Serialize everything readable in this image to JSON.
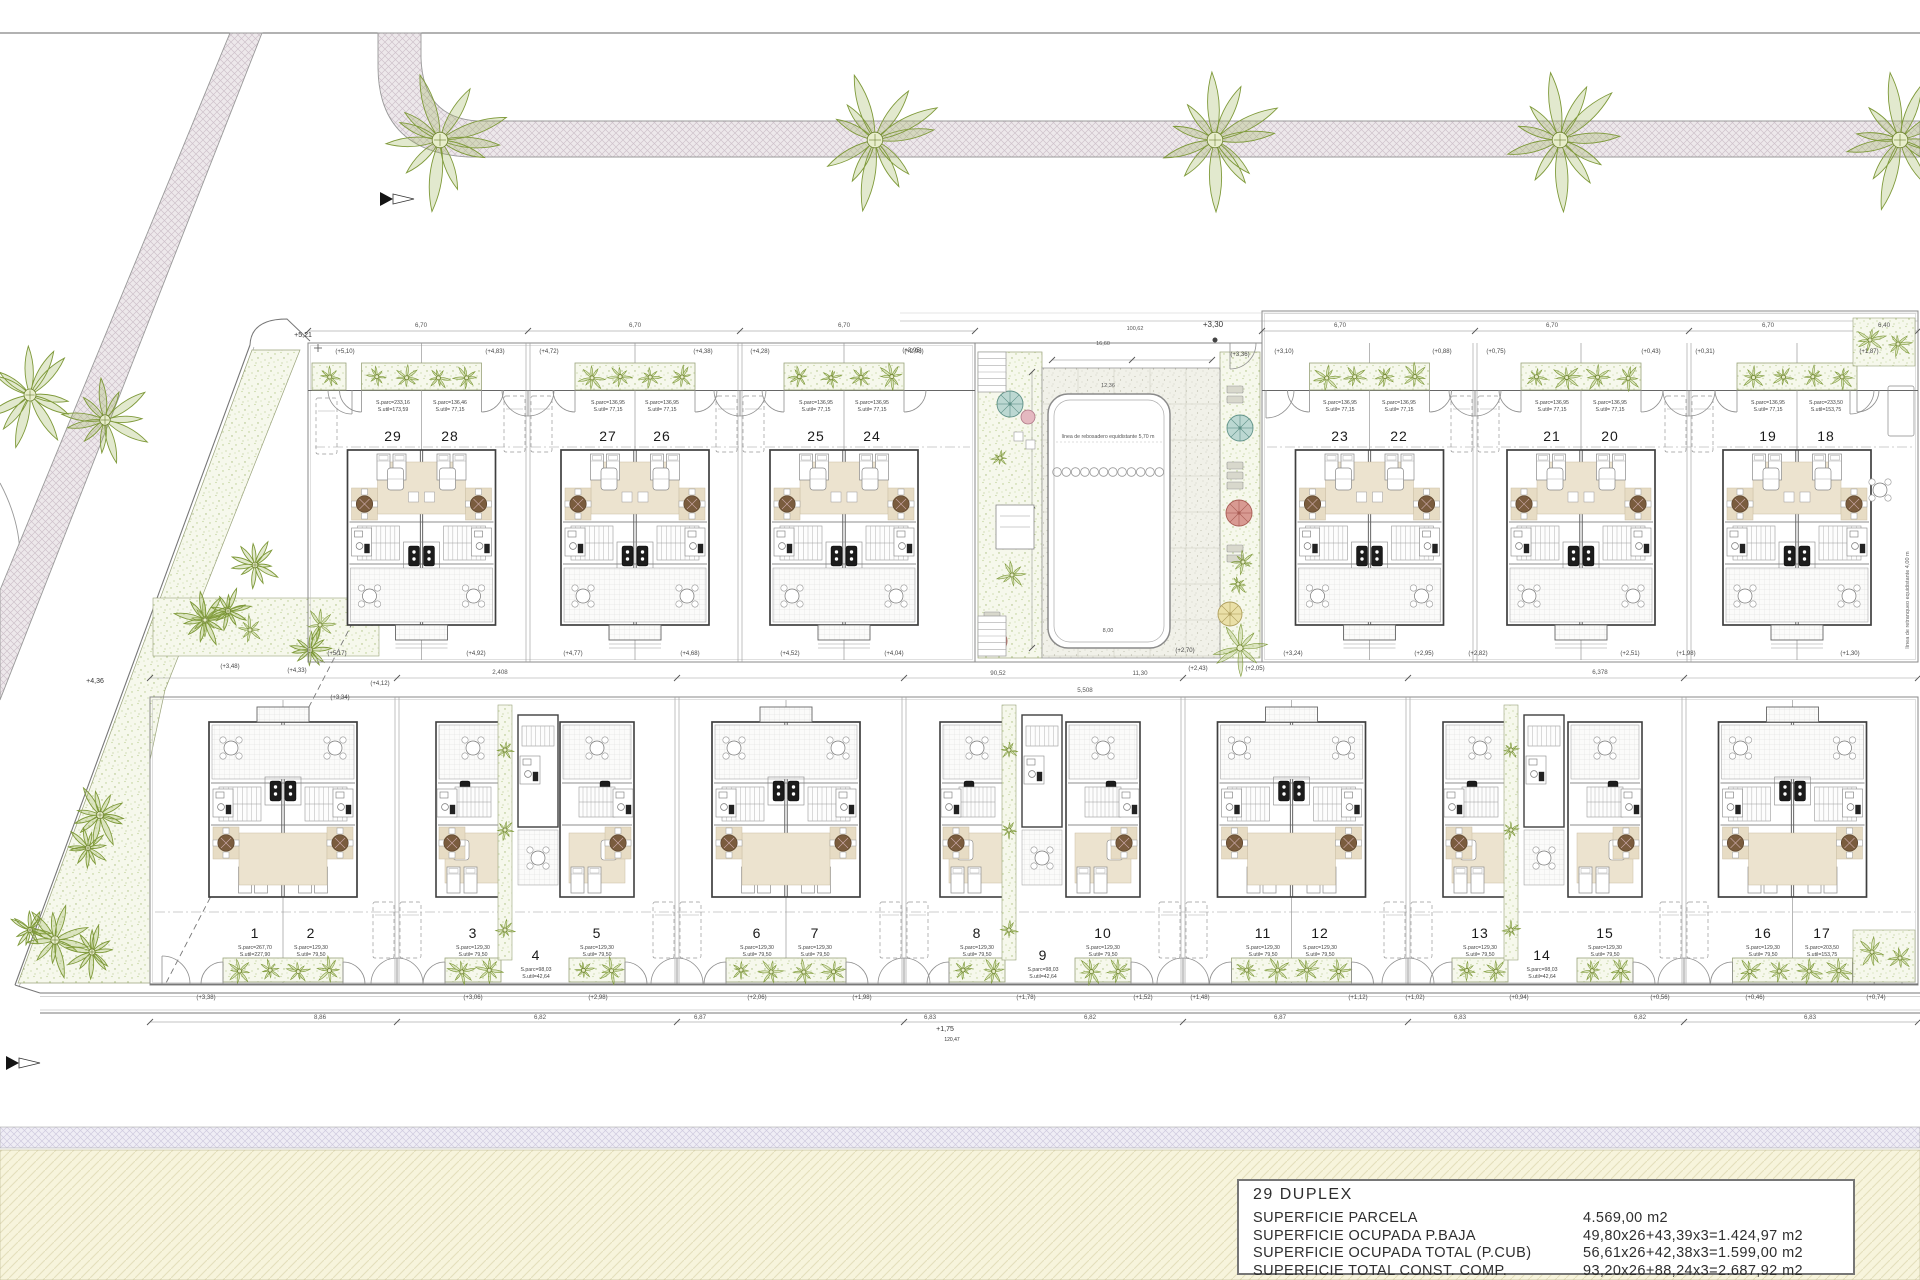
{
  "legend": {
    "title": "29 DUPLEX",
    "rows": [
      {
        "label": "SUPERFICIE PARCELA",
        "value": "4.569,00 m2"
      },
      {
        "label": "SUPERFICIE OCUPADA P.BAJA",
        "value": "49,80x26+43,39x3=1.424,97 m2"
      },
      {
        "label": "SUPERFICIE OCUPADA TOTAL (P.CUB)",
        "value": "56,61x26+42,38x3=1.599,00 m2"
      },
      {
        "label": "SUPERFICIE TOTAL CONST. COMP.",
        "value": "93,20x26+88,24x3=2.687,92 m2"
      }
    ]
  },
  "pool": {
    "note": "línea de rebosadero equidistante 5,70 m",
    "dims": [
      {
        "x": 1103,
        "y": 345,
        "t": "16,60"
      },
      {
        "x": 1108,
        "y": 387,
        "t": "12,36"
      },
      {
        "x": 1108,
        "y": 632,
        "t": "8,00"
      },
      {
        "x": 1135,
        "y": 330,
        "t": "100,62"
      }
    ],
    "level_top_right": "(+3,36)",
    "level_deck": "(+2,70)"
  },
  "markers": [
    {
      "x": 303,
      "y": 337,
      "t": "+5,21",
      "s": 7
    },
    {
      "x": 95,
      "y": 683,
      "t": "+4,36",
      "s": 7
    },
    {
      "x": 1213,
      "y": 327,
      "t": "+3,30",
      "s": 8
    },
    {
      "x": 945,
      "y": 1031,
      "t": "+1,75",
      "s": 7
    },
    {
      "x": 952,
      "y": 1041,
      "t": "120,47",
      "s": 5
    }
  ],
  "setback_right": "línea de retranqueo equidistante 4,00 m",
  "setback_garden": "línea de retranqueo equidistante 3,00 m",
  "units": [
    {
      "n": "29",
      "x": 393,
      "row": "top",
      "a1": "S.parc=233,16",
      "a2": "S.util=173,59"
    },
    {
      "n": "28",
      "x": 450,
      "row": "top",
      "a1": "S.parc=136,46",
      "a2": "S.util= 77,15"
    },
    {
      "n": "27",
      "x": 608,
      "row": "top",
      "a1": "S.parc=136,95",
      "a2": "S.util= 77,15"
    },
    {
      "n": "26",
      "x": 662,
      "row": "top",
      "a1": "S.parc=136,95",
      "a2": "S.util= 77,15"
    },
    {
      "n": "25",
      "x": 816,
      "row": "top",
      "a1": "S.parc=136,95",
      "a2": "S.util= 77,15"
    },
    {
      "n": "24",
      "x": 872,
      "row": "top",
      "a1": "S.parc=136,95",
      "a2": "S.util= 77,15"
    },
    {
      "n": "23",
      "x": 1340,
      "row": "top",
      "a1": "S.parc=136,95",
      "a2": "S.util= 77,15"
    },
    {
      "n": "22",
      "x": 1399,
      "row": "top",
      "a1": "S.parc=136,95",
      "a2": "S.util= 77,15"
    },
    {
      "n": "21",
      "x": 1552,
      "row": "top",
      "a1": "S.parc=136,95",
      "a2": "S.util= 77,15"
    },
    {
      "n": "20",
      "x": 1610,
      "row": "top",
      "a1": "S.parc=136,95",
      "a2": "S.util= 77,15"
    },
    {
      "n": "19",
      "x": 1768,
      "row": "top",
      "a1": "S.parc=136,95",
      "a2": "S.util= 77,15"
    },
    {
      "n": "18",
      "x": 1826,
      "row": "top",
      "a1": "S.parc=233,50",
      "a2": "S.util=153,75"
    },
    {
      "n": "1",
      "x": 255,
      "row": "bottom",
      "a1": "S.parc=267,70",
      "a2": "S.util=227,90"
    },
    {
      "n": "2",
      "x": 311,
      "row": "bottom",
      "a1": "S.parc=129,30",
      "a2": "S.util= 79,50"
    },
    {
      "n": "3",
      "x": 473,
      "row": "bottom",
      "a1": "S.parc=129,30",
      "a2": "S.util= 79,50"
    },
    {
      "n": "4",
      "x": 536,
      "row": "narrow",
      "a1": "S.parc=98,03",
      "a2": "S.util=42,64"
    },
    {
      "n": "5",
      "x": 597,
      "row": "bottom",
      "a1": "S.parc=129,30",
      "a2": "S.util= 79,50"
    },
    {
      "n": "6",
      "x": 757,
      "row": "bottom",
      "a1": "S.parc=129,30",
      "a2": "S.util= 79,50"
    },
    {
      "n": "7",
      "x": 815,
      "row": "bottom",
      "a1": "S.parc=129,30",
      "a2": "S.util= 79,50"
    },
    {
      "n": "8",
      "x": 977,
      "row": "bottom",
      "a1": "S.parc=129,30",
      "a2": "S.util= 79,50"
    },
    {
      "n": "9",
      "x": 1043,
      "row": "narrow",
      "a1": "S.parc=98,03",
      "a2": "S.util=42,64"
    },
    {
      "n": "10",
      "x": 1103,
      "row": "bottom",
      "a1": "S.parc=129,30",
      "a2": "S.util= 79,50"
    },
    {
      "n": "11",
      "x": 1263,
      "row": "bottom",
      "a1": "S.parc=129,30",
      "a2": "S.util= 79,50"
    },
    {
      "n": "12",
      "x": 1320,
      "row": "bottom",
      "a1": "S.parc=129,30",
      "a2": "S.util= 79,50"
    },
    {
      "n": "13",
      "x": 1480,
      "row": "bottom",
      "a1": "S.parc=129,30",
      "a2": "S.util= 79,50"
    },
    {
      "n": "14",
      "x": 1542,
      "row": "narrow",
      "a1": "S.parc=98,03",
      "a2": "S.util=42,64"
    },
    {
      "n": "15",
      "x": 1605,
      "row": "bottom",
      "a1": "S.parc=129,30",
      "a2": "S.util= 79,50"
    },
    {
      "n": "16",
      "x": 1763,
      "row": "bottom",
      "a1": "S.parc=129,30",
      "a2": "S.util= 79,50"
    },
    {
      "n": "17",
      "x": 1822,
      "row": "bottom",
      "a1": "S.parc=203,50",
      "a2": "S.util=153,75"
    }
  ],
  "levels": [
    {
      "x": 345,
      "y": 353,
      "t": "(+5,10)"
    },
    {
      "x": 495,
      "y": 353,
      "t": "(+4,83)"
    },
    {
      "x": 549,
      "y": 353,
      "t": "(+4,72)"
    },
    {
      "x": 703,
      "y": 353,
      "t": "(+4,38)"
    },
    {
      "x": 760,
      "y": 353,
      "t": "(+4,28)"
    },
    {
      "x": 914,
      "y": 353,
      "t": "(+2,98)"
    },
    {
      "x": 1284,
      "y": 353,
      "t": "(+3,10)"
    },
    {
      "x": 1442,
      "y": 353,
      "t": "(+0,88)"
    },
    {
      "x": 1496,
      "y": 353,
      "t": "(+0,75)"
    },
    {
      "x": 1651,
      "y": 353,
      "t": "(+0,43)"
    },
    {
      "x": 1705,
      "y": 353,
      "t": "(+0,31)"
    },
    {
      "x": 1869,
      "y": 353,
      "t": "(+1,87)"
    },
    {
      "x": 337,
      "y": 655,
      "t": "(+5,17)"
    },
    {
      "x": 476,
      "y": 655,
      "t": "(+4,92)"
    },
    {
      "x": 573,
      "y": 655,
      "t": "(+4,77)"
    },
    {
      "x": 690,
      "y": 655,
      "t": "(+4,68)"
    },
    {
      "x": 790,
      "y": 655,
      "t": "(+4,52)"
    },
    {
      "x": 894,
      "y": 655,
      "t": "(+4,04)"
    },
    {
      "x": 1293,
      "y": 655,
      "t": "(+3,24)"
    },
    {
      "x": 1424,
      "y": 655,
      "t": "(+2,95)"
    },
    {
      "x": 1478,
      "y": 655,
      "t": "(+2,82)"
    },
    {
      "x": 1630,
      "y": 655,
      "t": "(+2,51)"
    },
    {
      "x": 1686,
      "y": 655,
      "t": "(+1,98)"
    },
    {
      "x": 1850,
      "y": 655,
      "t": "(+1,30)"
    },
    {
      "x": 230,
      "y": 668,
      "t": "(+3,48)"
    },
    {
      "x": 297,
      "y": 672,
      "t": "(+4,33)"
    },
    {
      "x": 380,
      "y": 685,
      "t": "(+4,12)"
    },
    {
      "x": 340,
      "y": 699,
      "t": "(+3,34)"
    },
    {
      "x": 1198,
      "y": 670,
      "t": "(+2,43)"
    },
    {
      "x": 1255,
      "y": 670,
      "t": "(+2,05)"
    },
    {
      "x": 1240,
      "y": 356,
      "t": "(+3,36)"
    },
    {
      "x": 1185,
      "y": 652,
      "t": "(+2,70)"
    },
    {
      "x": 912,
      "y": 352,
      "t": "(+3,95)"
    },
    {
      "x": 206,
      "y": 999,
      "t": "(+3,38)"
    },
    {
      "x": 473,
      "y": 999,
      "t": "(+3,06)"
    },
    {
      "x": 598,
      "y": 999,
      "t": "(+2,98)"
    },
    {
      "x": 757,
      "y": 999,
      "t": "(+2,06)"
    },
    {
      "x": 862,
      "y": 999,
      "t": "(+1,98)"
    },
    {
      "x": 1026,
      "y": 999,
      "t": "(+1,78)"
    },
    {
      "x": 1143,
      "y": 999,
      "t": "(+1,52)"
    },
    {
      "x": 1200,
      "y": 999,
      "t": "(+1,48)"
    },
    {
      "x": 1358,
      "y": 999,
      "t": "(+1,12)"
    },
    {
      "x": 1415,
      "y": 999,
      "t": "(+1,02)"
    },
    {
      "x": 1519,
      "y": 999,
      "t": "(+0,94)"
    },
    {
      "x": 1660,
      "y": 999,
      "t": "(+0,56)"
    },
    {
      "x": 1755,
      "y": 999,
      "t": "(+0,46)"
    },
    {
      "x": 1876,
      "y": 999,
      "t": "(+0,74)"
    }
  ],
  "dims": [
    {
      "x": 421,
      "y": 327,
      "t": "6,70"
    },
    {
      "x": 635,
      "y": 327,
      "t": "6,70"
    },
    {
      "x": 844,
      "y": 327,
      "t": "6,70"
    },
    {
      "x": 1340,
      "y": 327,
      "t": "6,70"
    },
    {
      "x": 1552,
      "y": 327,
      "t": "6,70"
    },
    {
      "x": 1768,
      "y": 327,
      "t": "6,70"
    },
    {
      "x": 1884,
      "y": 327,
      "t": "6,40"
    },
    {
      "x": 500,
      "y": 674,
      "t": "2,408"
    },
    {
      "x": 998,
      "y": 675,
      "t": "90,52"
    },
    {
      "x": 1140,
      "y": 675,
      "t": "11,30"
    },
    {
      "x": 1600,
      "y": 674,
      "t": "6,378"
    },
    {
      "x": 1085,
      "y": 692,
      "t": "5,508"
    },
    {
      "x": 320,
      "y": 1019,
      "t": "8,86"
    },
    {
      "x": 540,
      "y": 1019,
      "t": "6,82"
    },
    {
      "x": 700,
      "y": 1019,
      "t": "6,87"
    },
    {
      "x": 930,
      "y": 1019,
      "t": "6,83"
    },
    {
      "x": 1090,
      "y": 1019,
      "t": "6,82"
    },
    {
      "x": 1280,
      "y": 1019,
      "t": "6,87"
    },
    {
      "x": 1460,
      "y": 1019,
      "t": "6,83"
    },
    {
      "x": 1640,
      "y": 1019,
      "t": "6,82"
    },
    {
      "x": 1810,
      "y": 1019,
      "t": "6,83"
    }
  ],
  "layout": {
    "blocks": {
      "top_left": [
        308,
        343,
        667,
        319
      ],
      "top_right": [
        1262,
        311,
        656,
        351
      ],
      "bottom": [
        150,
        697,
        1768,
        288
      ]
    },
    "buildings_top": [
      421.5,
      635,
      844,
      1369.5,
      1581,
      1797
    ],
    "pairs_bottom": [
      283,
      786,
      1291.5,
      1792.5
    ],
    "halves_bottom": [
      [
        473,
        -1
      ],
      [
        597,
        1
      ],
      [
        977,
        -1
      ],
      [
        1103,
        1
      ],
      [
        1480,
        -1
      ],
      [
        1605,
        1
      ]
    ],
    "narrow_bottom": [
      536,
      1040,
      1542
    ],
    "strips_top": [
      528,
      740,
      1475,
      1689
    ],
    "strips_bottom": [
      397,
      677,
      904,
      1183,
      1408,
      1684
    ],
    "trees_road": [
      440,
      875,
      1215,
      1560,
      1900
    ],
    "palms_west": [
      [
        30,
        395,
        46
      ],
      [
        105,
        420,
        40
      ]
    ],
    "palms_garden": [
      [
        205,
        620,
        26
      ],
      [
        228,
        611,
        20
      ],
      [
        255,
        565,
        22
      ],
      [
        310,
        650,
        20
      ],
      [
        100,
        815,
        28
      ],
      [
        88,
        848,
        20
      ],
      [
        55,
        940,
        32
      ],
      [
        92,
        952,
        24
      ],
      [
        30,
        930,
        18
      ]
    ],
    "palms_courtyard": [
      [
        1012,
        575,
        13
      ],
      [
        1000,
        458,
        8
      ],
      [
        1243,
        562,
        11
      ],
      [
        1238,
        584,
        9
      ],
      [
        1240,
        648,
        24
      ]
    ],
    "pennants": [
      [
        380,
        192
      ],
      [
        6,
        1056
      ]
    ]
  },
  "colors": {
    "road_fill": "#ede8eb",
    "road_line": "#cfc2cb",
    "road_edge": "#9a9a9a",
    "lavender_fill": "#efedf5",
    "lavender_line": "#cfcade",
    "cream_fill": "#f7f4dc",
    "cream_line": "#e4dfbc",
    "stipple_bg": "#f6f8ec",
    "stipple_dot": "#b9cc8e",
    "deck_bg": "#f1f1e9",
    "deck_dot": "#c5c5b6",
    "wall": "#3f3f3f",
    "thin": "#8a8a8a",
    "beige": "#ece3cf",
    "mat": "#e7dcc4",
    "table": "#7a5c3e",
    "leaf": "#7f9a3a",
    "leaf_fill": "rgba(150,175,80,0.28)",
    "umbrella_teal": "#bcd8d2",
    "umbrella_red": "#d89a92",
    "umbrella_yellow": "#eae0a8",
    "umbrella_pink": "#e4b8c0",
    "text": "#333333"
  }
}
